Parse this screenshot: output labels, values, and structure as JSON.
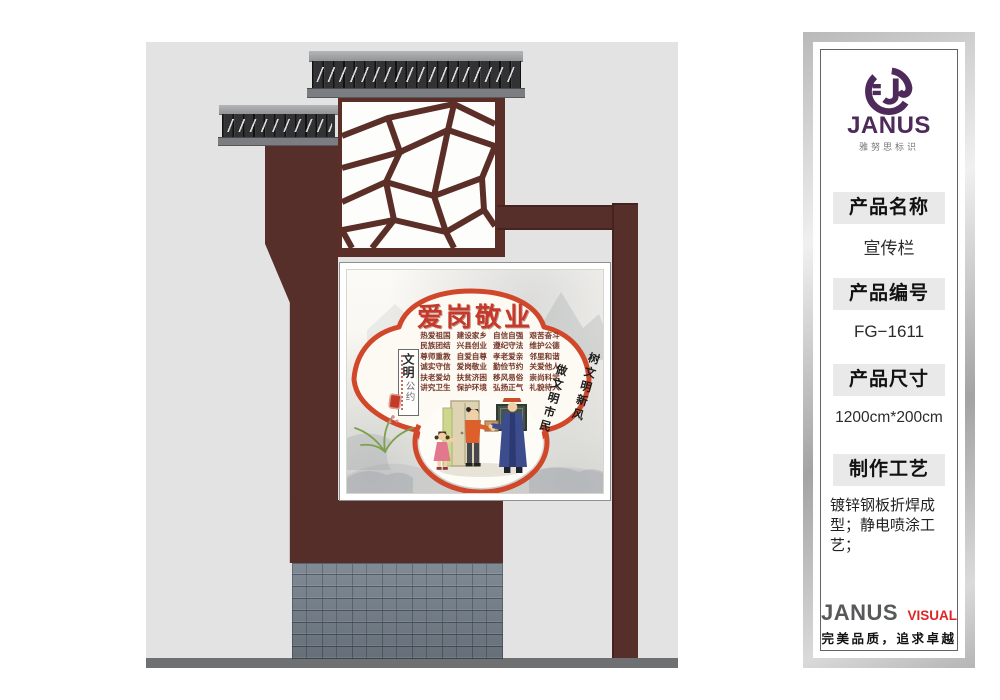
{
  "illustration": {
    "colors": {
      "structure_maroon": "#562e29",
      "roof_dark": "#323133",
      "backdrop_gray": "#e3e3e4",
      "ground_gray": "#6f7071",
      "brick_gray": "#76818c",
      "poster_accent_red": "#d0472a",
      "title_red": "#c5392b"
    },
    "poster": {
      "title": "爱岗敬业",
      "left_box": {
        "line1": "文明",
        "line2": "公约"
      },
      "phrases": [
        "热爱祖国",
        "建设家乡",
        "自信自强",
        "艰苦奋斗",
        "民族团结",
        "兴县创业",
        "遵纪守法",
        "维护公德",
        "尊师重教",
        "自爱自尊",
        "孝老爱亲",
        "邻里和谐",
        "诚实守信",
        "爱岗敬业",
        "勤俭节约",
        "关爱他人",
        "扶老爱幼",
        "扶贫济困",
        "移风易俗",
        "崇尚科学",
        "讲究卫生",
        "保护环境",
        "弘扬正气",
        "礼貌待人"
      ],
      "motto_columns": [
        "树文明新风",
        "做文明市民"
      ]
    }
  },
  "sidebar": {
    "brand": {
      "logo_icon": "janus-logo-icon",
      "name": "JANUS",
      "subtitle": "雅努思标识",
      "brand_purple": "#4e2a5a"
    },
    "fields": [
      {
        "label": "产品名称",
        "value": "宣传栏"
      },
      {
        "label": "产品编号",
        "value": "FG−1611"
      },
      {
        "label": "产品尺寸",
        "value": "1200cm*200cm"
      },
      {
        "label": "制作工艺",
        "value": "镀锌钢板折焊成型；静电喷涂工艺；"
      }
    ],
    "footer": {
      "brand": "JANUS",
      "brand_suffix": "VISUAL",
      "suffix_red": "#e02525",
      "tagline": "完美品质，追求卓越"
    }
  }
}
